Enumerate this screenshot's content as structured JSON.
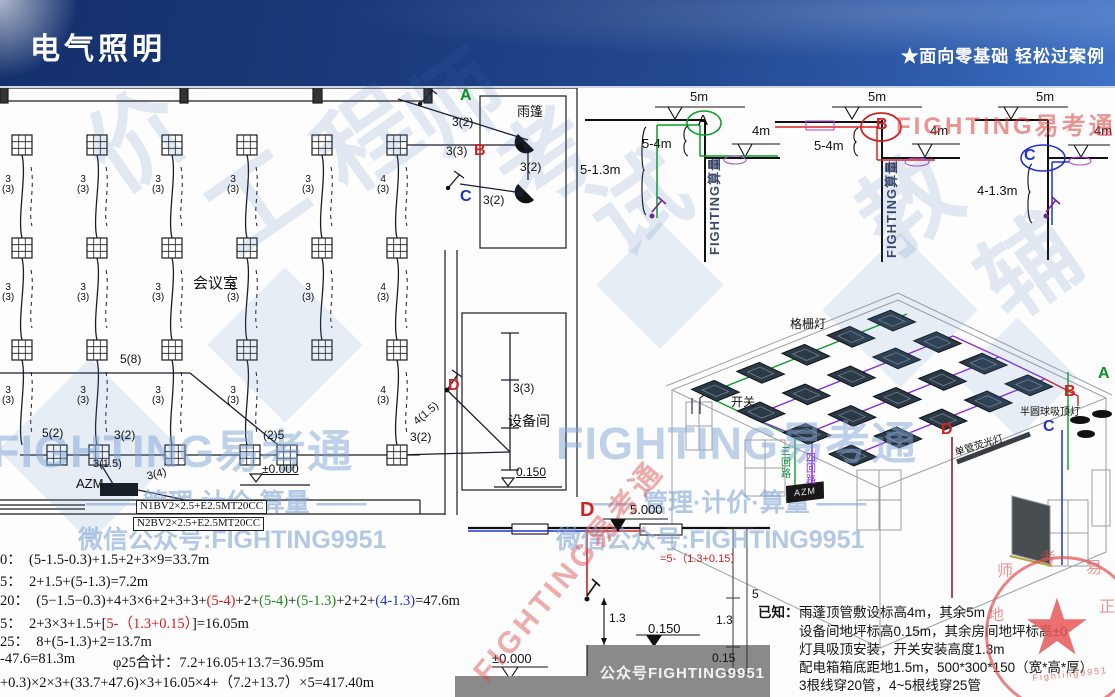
{
  "header": {
    "title": "电气照明",
    "tagline": "★面向零基础 轻松过案例"
  },
  "floor_plan": {
    "labels": [
      {
        "n": "room-label",
        "t": "会议室",
        "x": 193,
        "y": 276,
        "cls": "t15"
      },
      {
        "n": "canopy-label",
        "t": "雨篷",
        "x": 517,
        "y": 105,
        "cls": "t13"
      },
      {
        "n": "equip-room-label",
        "t": "设备间",
        "x": 508,
        "y": 414,
        "cls": "t14"
      },
      {
        "n": "point-a",
        "t": "A",
        "x": 460,
        "y": 88,
        "cls": "pt g"
      },
      {
        "n": "point-b",
        "t": "B",
        "x": 474,
        "y": 143,
        "cls": "pt r"
      },
      {
        "n": "point-c",
        "t": "C",
        "x": 460,
        "y": 189,
        "cls": "pt b"
      },
      {
        "n": "point-d",
        "t": "D",
        "x": 448,
        "y": 378,
        "cls": "pt r"
      },
      {
        "n": "azm-label",
        "t": "AZM",
        "x": 76,
        "y": 477,
        "cls": "t13"
      },
      {
        "n": "elev-zero-label",
        "t": "±0.000",
        "x": 262,
        "y": 463,
        "cls": "t12 u"
      },
      {
        "n": "elev-0150-label",
        "t": "0.150",
        "x": 516,
        "y": 466,
        "cls": "t12 u"
      },
      {
        "n": "cable-spec-n1",
        "t": "N1BV2×2.5+E2.5MT20CC",
        "x": 136,
        "y": 500,
        "cls": "spec"
      },
      {
        "n": "cable-spec-n2",
        "t": "N2BV2×2.5+E2.5MT20CC",
        "x": 133,
        "y": 517,
        "cls": "spec"
      },
      {
        "n": "wire-label",
        "t": "3\n(3)",
        "x": 2,
        "y": 175,
        "cls": "w"
      },
      {
        "n": "wire-label",
        "t": "3\n(3)",
        "x": 77,
        "y": 175,
        "cls": "w"
      },
      {
        "n": "wire-label",
        "t": "3\n(3)",
        "x": 152,
        "y": 175,
        "cls": "w"
      },
      {
        "n": "wire-label",
        "t": "3\n(3)",
        "x": 227,
        "y": 175,
        "cls": "w"
      },
      {
        "n": "wire-label",
        "t": "3\n(3)",
        "x": 302,
        "y": 175,
        "cls": "w"
      },
      {
        "n": "wire-label",
        "t": "4\n(3)",
        "x": 377,
        "y": 175,
        "cls": "w"
      },
      {
        "n": "wire-label",
        "t": "3\n(3)",
        "x": 2,
        "y": 283,
        "cls": "w"
      },
      {
        "n": "wire-label",
        "t": "3\n(3)",
        "x": 77,
        "y": 283,
        "cls": "w"
      },
      {
        "n": "wire-label",
        "t": "3\n(3)",
        "x": 152,
        "y": 283,
        "cls": "w"
      },
      {
        "n": "wire-label",
        "t": "3\n(3)",
        "x": 227,
        "y": 283,
        "cls": "w"
      },
      {
        "n": "wire-label",
        "t": "3\n(3)",
        "x": 302,
        "y": 283,
        "cls": "w"
      },
      {
        "n": "wire-label",
        "t": "4\n(3)",
        "x": 377,
        "y": 283,
        "cls": "w"
      },
      {
        "n": "wire-label",
        "t": "3\n(3)",
        "x": 2,
        "y": 386,
        "cls": "w"
      },
      {
        "n": "wire-label",
        "t": "3\n(3)",
        "x": 77,
        "y": 386,
        "cls": "w"
      },
      {
        "n": "wire-label",
        "t": "3\n(3)",
        "x": 152,
        "y": 386,
        "cls": "w"
      },
      {
        "n": "wire-label",
        "t": "3\n(3)",
        "x": 227,
        "y": 386,
        "cls": "w"
      },
      {
        "n": "wire-label",
        "t": "4\n(3)",
        "x": 377,
        "y": 386,
        "cls": "w"
      },
      {
        "n": "wire-label",
        "t": "5(8)",
        "x": 120,
        "y": 353,
        "cls": "t12"
      },
      {
        "n": "wire-label",
        "t": "5(2)",
        "x": 42,
        "y": 427,
        "cls": "t12"
      },
      {
        "n": "wire-label",
        "t": "3(2)",
        "x": 114,
        "y": 429,
        "cls": "t12"
      },
      {
        "n": "wire-label",
        "t": "(2)5",
        "x": 263,
        "y": 429,
        "cls": "t12"
      },
      {
        "n": "wire-label",
        "t": "3(1.5)",
        "x": 93,
        "y": 459,
        "cls": "t11"
      },
      {
        "n": "wire-label",
        "t": "3(4)",
        "x": 146,
        "y": 472,
        "cls": "t11",
        "rot": -14
      },
      {
        "n": "wire-label",
        "t": "3(2)",
        "x": 452,
        "y": 116,
        "cls": "t12"
      },
      {
        "n": "wire-label",
        "t": "3(3)",
        "x": 446,
        "y": 145,
        "cls": "t12"
      },
      {
        "n": "wire-label",
        "t": "3(2)",
        "x": 520,
        "y": 161,
        "cls": "t12"
      },
      {
        "n": "wire-label",
        "t": "3(2)",
        "x": 483,
        "y": 194,
        "cls": "t12"
      },
      {
        "n": "wire-label",
        "t": "4(1.5)",
        "x": 412,
        "y": 419,
        "cls": "t11",
        "rot": -40
      },
      {
        "n": "wire-label",
        "t": "3(3)",
        "x": 513,
        "y": 382,
        "cls": "t12"
      },
      {
        "n": "wire-label",
        "t": "3(2)",
        "x": 410,
        "y": 431,
        "cls": "t12"
      }
    ],
    "lights": [
      [
        22,
        145
      ],
      [
        97,
        145
      ],
      [
        172,
        145
      ],
      [
        247,
        145
      ],
      [
        322,
        145
      ],
      [
        397,
        145
      ],
      [
        22,
        248
      ],
      [
        97,
        248
      ],
      [
        172,
        248
      ],
      [
        247,
        248
      ],
      [
        322,
        248
      ],
      [
        397,
        248
      ],
      [
        22,
        350
      ],
      [
        97,
        350
      ],
      [
        172,
        350
      ],
      [
        247,
        350
      ],
      [
        322,
        350
      ],
      [
        397,
        350
      ],
      [
        57,
        455
      ],
      [
        99,
        455
      ],
      [
        175,
        455
      ],
      [
        250,
        455
      ],
      [
        287,
        455
      ],
      [
        397,
        455
      ]
    ],
    "wire_columns": [
      {
        "x": 22,
        "segs": [
          [
            155,
            238
          ],
          [
            258,
            340
          ],
          [
            360,
            445
          ]
        ]
      },
      {
        "x": 97,
        "segs": [
          [
            155,
            238
          ],
          [
            258,
            340
          ],
          [
            360,
            445
          ]
        ]
      },
      {
        "x": 172,
        "segs": [
          [
            155,
            238
          ],
          [
            258,
            340
          ],
          [
            360,
            445
          ]
        ]
      },
      {
        "x": 247,
        "segs": [
          [
            155,
            238
          ],
          [
            258,
            340
          ],
          [
            360,
            445
          ]
        ]
      },
      {
        "x": 322,
        "segs": [
          [
            155,
            238
          ],
          [
            258,
            340
          ]
        ]
      },
      {
        "x": 397,
        "segs": [
          [
            155,
            238
          ],
          [
            258,
            340
          ],
          [
            360,
            445
          ]
        ]
      }
    ]
  },
  "elevations": {
    "labels": [
      {
        "n": "dim-5m",
        "t": "5m",
        "x": 690,
        "y": 90,
        "cls": "t13"
      },
      {
        "n": "dim-5m",
        "t": "5m",
        "x": 868,
        "y": 90,
        "cls": "t13"
      },
      {
        "n": "dim-5m",
        "t": "5m",
        "x": 1036,
        "y": 90,
        "cls": "t13"
      },
      {
        "n": "dim-4m",
        "t": "4m",
        "x": 752,
        "y": 124,
        "cls": "t13"
      },
      {
        "n": "dim-4m",
        "t": "4m",
        "x": 930,
        "y": 124,
        "cls": "t13"
      },
      {
        "n": "dim-4m",
        "t": "4m",
        "x": 1094,
        "y": 124,
        "cls": "t13"
      },
      {
        "n": "dim-5-4m",
        "t": "5-4m",
        "x": 642,
        "y": 137,
        "cls": "t13"
      },
      {
        "n": "dim-5-4m",
        "t": "5-4m",
        "x": 814,
        "y": 139,
        "cls": "t13"
      },
      {
        "n": "dim-5-1-3m",
        "t": "5-1.3m",
        "x": 580,
        "y": 163,
        "cls": "t13"
      },
      {
        "n": "dim-4-1-3m",
        "t": "4-1.3m",
        "x": 977,
        "y": 184,
        "cls": "t13"
      },
      {
        "n": "circled-a",
        "t": "A",
        "x": 698,
        "y": 113,
        "cls": "t15"
      },
      {
        "n": "circled-b",
        "t": "B",
        "x": 876,
        "y": 117,
        "cls": "pt r"
      },
      {
        "n": "circled-c",
        "t": "C",
        "x": 1024,
        "y": 148,
        "cls": "pt b"
      },
      {
        "n": "wm-vertical",
        "t": "FIGHTING算量",
        "x": 708,
        "y": 255,
        "cls": "vwm"
      },
      {
        "n": "wm-vertical",
        "t": "FIGHTING算量",
        "x": 885,
        "y": 258,
        "cls": "vwm"
      },
      {
        "n": "wm-red",
        "t": "FIGHTING易考通",
        "x": 896,
        "y": 114,
        "cls": "redwm"
      }
    ]
  },
  "isometric": {
    "labels": [
      {
        "n": "grille-light-label",
        "t": "格栅灯",
        "x": 790,
        "y": 318,
        "cls": "t12"
      },
      {
        "n": "switch-label",
        "t": "开关",
        "x": 731,
        "y": 396,
        "cls": "t12"
      },
      {
        "n": "point-a",
        "t": "A",
        "x": 1098,
        "y": 366,
        "cls": "pt g"
      },
      {
        "n": "point-b",
        "t": "B",
        "x": 1064,
        "y": 384,
        "cls": "pt r"
      },
      {
        "n": "point-c",
        "t": "C",
        "x": 1043,
        "y": 419,
        "cls": "pt b"
      },
      {
        "n": "point-d",
        "t": "D",
        "x": 941,
        "y": 422,
        "cls": "pt r"
      },
      {
        "n": "dome-lamp-label",
        "t": "半圆球吸顶灯",
        "x": 1020,
        "y": 408,
        "cls": "t10"
      },
      {
        "n": "tube-lamp-label",
        "t": "单管荧光灯",
        "x": 954,
        "y": 449,
        "cls": "t10",
        "rot": -17
      },
      {
        "n": "azm-box",
        "t": "AZM",
        "x": 786,
        "y": 486,
        "cls": "azmtag"
      },
      {
        "n": "circuit-label-green",
        "t": "三回路",
        "x": 778,
        "y": 446,
        "cls": "vgreen"
      },
      {
        "n": "circuit-label-purple",
        "t": "四回路",
        "x": 803,
        "y": 452,
        "cls": "vpurple"
      }
    ],
    "ceiling": {
      "a": [
        672,
        390
      ],
      "b": [
        898,
        300
      ],
      "d": [
        880,
        488
      ]
    },
    "light_us": [
      0.1,
      0.3,
      0.5,
      0.7,
      0.88
    ],
    "light_vs": [
      0.1,
      0.32,
      0.54,
      0.76
    ]
  },
  "bottom_elevation": {
    "labels": [
      {
        "n": "point-d",
        "t": "D",
        "x": 580,
        "y": 500,
        "cls": "ptb r"
      },
      {
        "n": "elev-5000",
        "t": "5.000",
        "x": 630,
        "y": 503,
        "cls": "t13"
      },
      {
        "n": "height-formula-red",
        "t": "=5-（1.3+0.15）",
        "x": 660,
        "y": 554,
        "cls": "t11 red"
      },
      {
        "n": "dim-1-3",
        "t": "1.3",
        "x": 609,
        "y": 612,
        "cls": "t12"
      },
      {
        "n": "elev-0150",
        "t": "0.150",
        "x": 648,
        "y": 622,
        "cls": "t13"
      },
      {
        "n": "elev-zero",
        "t": "±0.000",
        "x": 492,
        "y": 652,
        "cls": "t13"
      },
      {
        "n": "floor-watermark",
        "t": "公众号FIGHTING9951",
        "x": 600,
        "y": 666,
        "cls": "floorwm"
      },
      {
        "n": "dim-5",
        "t": "5",
        "x": 752,
        "y": 588,
        "cls": "t12"
      },
      {
        "n": "dim-1-3",
        "t": "1.3",
        "x": 716,
        "y": 614,
        "cls": "t12"
      },
      {
        "n": "dim-0-15",
        "t": "0.15",
        "x": 712,
        "y": 652,
        "cls": "t12"
      },
      {
        "n": "wm-red-diagonal",
        "t": "FIGHTING易考通",
        "x": 468,
        "y": 668,
        "cls": "reddiag",
        "rot": -50
      }
    ]
  },
  "calculations": {
    "line1": "0：  (5-1.5-0.3)+1.5+2+3×9=33.7m",
    "line2": "5：  2+1.5+(5-1.3)=7.2m",
    "line3_segments": [
      {
        "t": "20：  (5−1.5−0.3)+4+3×6+2+3+3+"
      },
      {
        "t": "(5-4)",
        "c": "#d42020"
      },
      {
        "t": "+2+"
      },
      {
        "t": "(5-4)",
        "c": "#1a8a1a"
      },
      {
        "t": "+"
      },
      {
        "t": "(5-1.3)",
        "c": "#1a8a1a"
      },
      {
        "t": "+2+2+"
      },
      {
        "t": "(4-1.3)",
        "c": "#2233cc"
      },
      {
        "t": "=47.6m"
      }
    ],
    "line4_segments": [
      {
        "t": "5：  2+3×3+1.5+["
      },
      {
        "t": "5-（1.3+0.15）",
        "c": "#d42020"
      },
      {
        "t": "]=16.05m"
      }
    ],
    "line5": "25：  8+(5-1.3)+2=13.7m",
    "line6a": "-47.6=81.3m",
    "line6b": "φ25合计：7.2+16.05+13.7=36.95m",
    "line7": "+0.3)×2×3+(33.7+47.6)×3+16.05×4+（7.2+13.7）×5=417.40m"
  },
  "notes": {
    "prefix": "已知：",
    "lines": [
      "雨蓬顶管敷设标高4m，其余5m",
      "设备间地坪标高0.15m，其余房间地坪标高±0",
      "灯具吸顶安装，开关安装高度1.3m",
      "配电箱箱底距地1.5m，500*300*150（宽*高*厚）",
      "3根线穿20管，4~5根线穿25管"
    ]
  },
  "watermarks": {
    "labels": [
      {
        "n": "wm-char",
        "t": "价",
        "x": 70,
        "y": 128,
        "cls": "wmchar",
        "rot": -35
      },
      {
        "n": "wm-char",
        "t": "工",
        "x": 190,
        "y": 190,
        "cls": "wmchar",
        "rot": -35
      },
      {
        "n": "wm-char",
        "t": "程",
        "x": 300,
        "y": 128,
        "cls": "wmchar",
        "rot": -35
      },
      {
        "n": "wm-char",
        "t": "师",
        "x": 388,
        "y": 92,
        "cls": "wmchar",
        "rot": -35
      },
      {
        "n": "wm-char",
        "t": "考",
        "x": 478,
        "y": 148,
        "cls": "wmchar",
        "rot": -35
      },
      {
        "n": "wm-char",
        "t": "试",
        "x": 572,
        "y": 192,
        "cls": "wmchar",
        "rot": -35
      },
      {
        "n": "wm-char",
        "t": "教",
        "x": 842,
        "y": 192,
        "cls": "wmchar",
        "rot": -35
      },
      {
        "n": "wm-char",
        "t": "辅",
        "x": 962,
        "y": 255,
        "cls": "wmchar",
        "rot": -35
      },
      {
        "n": "wm-brand",
        "t": "FIGHTING易考通",
        "x": -8,
        "y": 428,
        "cls": "bigwm"
      },
      {
        "n": "wm-brand",
        "t": "FIGHTING易考通",
        "x": 556,
        "y": 420,
        "cls": "bigwm"
      },
      {
        "n": "wm-slogan",
        "t": "—— 管理·计价·算量 ——",
        "x": 86,
        "y": 490,
        "cls": "midwm"
      },
      {
        "n": "wm-slogan",
        "t": "—— 管理·计价·算量 ——",
        "x": 586,
        "y": 490,
        "cls": "midwm"
      },
      {
        "n": "wm-wechat",
        "t": "微信公众号:FIGHTING9951",
        "x": 78,
        "y": 527,
        "cls": "midwm"
      },
      {
        "n": "wm-wechat",
        "t": "微信公众号:FIGHTING9951",
        "x": 556,
        "y": 527,
        "cls": "midwm"
      }
    ]
  },
  "seal": {
    "star": "★",
    "labels": [
      {
        "n": "seal-char",
        "t": "师",
        "x": 997,
        "y": 564,
        "cls": "sealch"
      },
      {
        "n": "seal-char",
        "t": "考",
        "x": 1040,
        "y": 551,
        "cls": "sealch"
      },
      {
        "n": "seal-char",
        "t": "易",
        "x": 1086,
        "y": 561,
        "cls": "sealch"
      },
      {
        "n": "seal-char",
        "t": "地",
        "x": 988,
        "y": 608,
        "cls": "sealch"
      },
      {
        "n": "seal-char",
        "t": "正",
        "x": 1099,
        "y": 600,
        "cls": "sealch"
      },
      {
        "n": "seal-text",
        "t": "Fighting9951",
        "x": 1032,
        "y": 674,
        "cls": "sealsm",
        "rot": -6
      }
    ]
  }
}
